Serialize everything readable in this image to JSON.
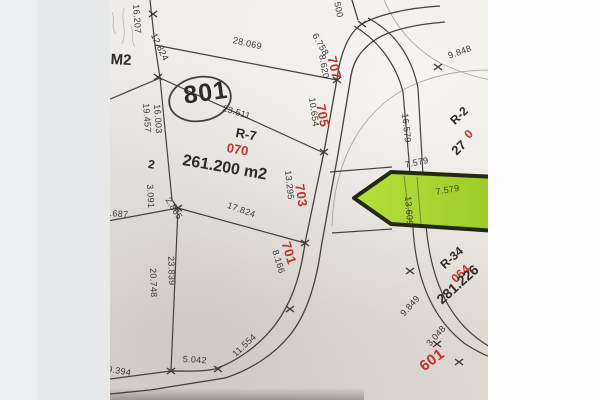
{
  "parcels": {
    "r7": {
      "code": "R-7",
      "parcel_id": "070",
      "area": "261.200 m2",
      "lot_number": "2"
    },
    "r34": {
      "code": "R-34",
      "parcel_id": "064",
      "area": "281.226"
    },
    "r2": {
      "code": "R-2",
      "parcel_id": "0",
      "area": "27"
    },
    "lot_circle": "801",
    "block_label": "M2"
  },
  "road_labels": {
    "n707": "707",
    "n705": "705",
    "n703": "703",
    "n701": "701",
    "n601": "601"
  },
  "dimensions": {
    "d500": "500",
    "d6758": "6.758",
    "d8620": "8.620",
    "d16207": "16.207",
    "d12824": "12.824",
    "d28069": "28.069",
    "d23511": "23.511",
    "d10654": "10.654",
    "d9848": "9.848",
    "d16579": "16.579",
    "d19457": "19.457",
    "d16003": "16.003",
    "d3091": "3.091",
    "d2855": "2.855",
    "d66": "66",
    "d687": ".687",
    "d17824": "17.824",
    "d13295": "13.295",
    "d7579_top": "7.579",
    "d7579_green": "7.579",
    "d13609": "13.609",
    "d8166": "8.166",
    "d23839": "23.839",
    "d20748": "20.748",
    "d11554": "11.554",
    "d5042": "5.042",
    "d9394": "9.394",
    "d9849": "9.849",
    "d3048": "3.048"
  },
  "colors": {
    "highlight_green": "#a8d832",
    "label_red": "#c2312b",
    "ink": "#3a352f",
    "paper": "#e9e6e1"
  }
}
